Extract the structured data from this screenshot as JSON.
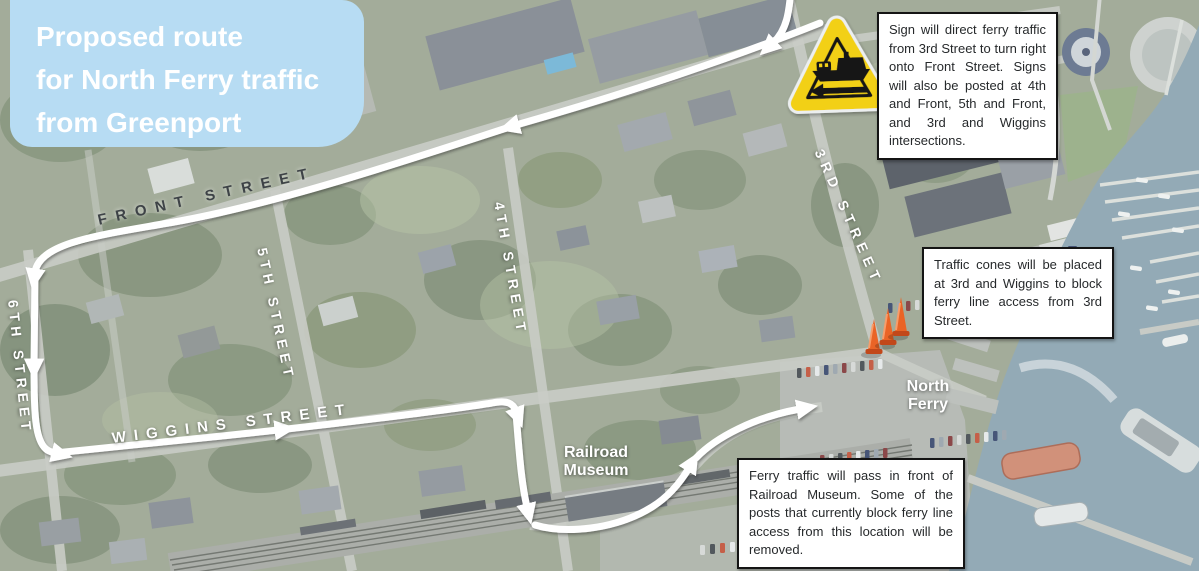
{
  "title": {
    "lines": [
      "Proposed route",
      "for North Ferry traffic",
      "from Greenport"
    ]
  },
  "callouts": {
    "sign_callout": "Sign will direct ferry traffic from 3rd Street to turn right onto Front Street. Signs will also be posted at 4th and Front, 5th and Front, and 3rd and Wiggins intersections.",
    "cones_callout": "Traffic cones will be placed at 3rd and Wiggins to block ferry line access from 3rd Street.",
    "museum_callout": "Ferry traffic will pass in front of Railroad Museum. Some of the posts that currently block ferry line access from this location will be removed."
  },
  "streets": {
    "front": "FRONT STREET",
    "wiggins": "WIGGINS STREET",
    "third": "3RD STREET",
    "fourth": "4TH STREET",
    "fifth": "5TH STREET",
    "sixth": "6TH STREET"
  },
  "pois": {
    "north_ferry": [
      "North",
      "Ferry"
    ],
    "railroad_museum": [
      "Railroad",
      "Museum"
    ]
  },
  "icons": {
    "ferry_sign": "ferry-crossing-warning-sign",
    "cones": "traffic-cones"
  },
  "colors": {
    "title_bg": "#b7dcf3",
    "route_arrow": "#ffffff",
    "sign_yellow": "#f2d012",
    "cone_orange": "#ea6426",
    "water": "#87a1ae"
  }
}
